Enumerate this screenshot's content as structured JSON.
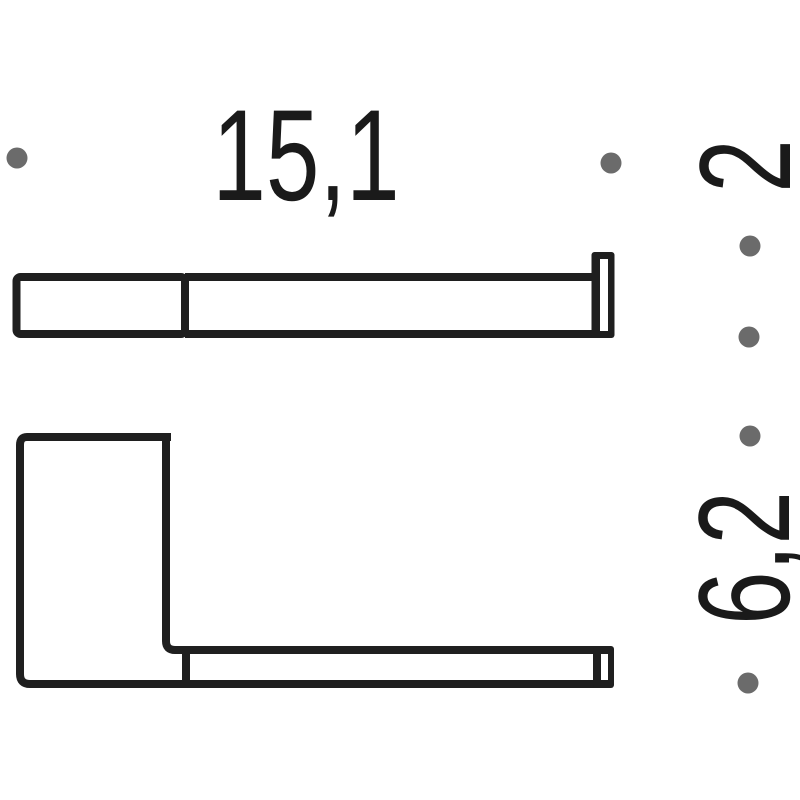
{
  "drawing": {
    "type": "technical-dimension-drawing",
    "colors": {
      "line": "#1f1f1f",
      "text": "#1a1a1a",
      "dot": "#6b6b6b",
      "background": "#ffffff"
    },
    "labels": {
      "length": "15,1",
      "height": "2",
      "depth": "6,2"
    }
  }
}
